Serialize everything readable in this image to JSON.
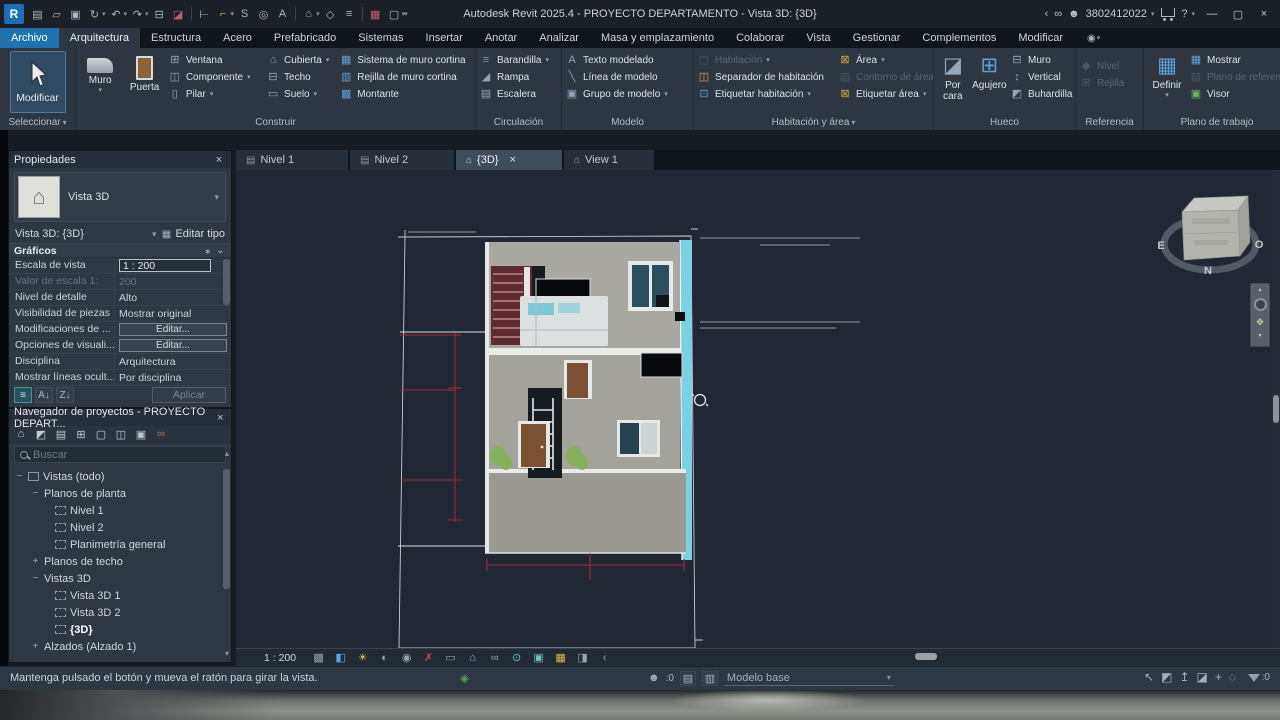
{
  "colors": {
    "accent_blue": "#1e73ae",
    "ribbon_bg": "#2e3741",
    "canvas_bg": "#212834",
    "model_teal_wall": "#7bd0e2",
    "dimension_red": "#9c2e36",
    "icon_blue": "#5f9fd6",
    "icon_yellow": "#d8a83c"
  },
  "icons": {
    "revit": "R",
    "doc": "▤",
    "folder": "▱",
    "save": "▣",
    "sync": "↻",
    "undo": "↶",
    "redo": "↷",
    "print": "⊟",
    "transfer": "◪",
    "measure": "⊢",
    "dimension": "⌐",
    "spline": "S",
    "tag": "◎",
    "text": "A",
    "home": "⌂",
    "marker": "◇",
    "thinlines": "≡",
    "closewin": "▦",
    "cascade": "▢",
    "chev_left": "‹",
    "binoculars": "∞",
    "user": "☻",
    "help": "?",
    "minimize": "—",
    "restore": "▢",
    "close": "×",
    "camera": "◉",
    "window": "⊞",
    "component": "◫",
    "pillar": "▯",
    "roof": "⌂",
    "ceiling": "⊟",
    "floor": "▭",
    "curtain_system": "▦",
    "curtain_grid": "▥",
    "mullion": "▩",
    "railing": "≡",
    "ramp": "◢",
    "stair": "▤",
    "model_text": "A",
    "model_line": "╲",
    "model_group": "▣",
    "room": "▢",
    "room_separator": "◫",
    "tag_room": "⊡",
    "area": "⊠",
    "area_boundary": "▧",
    "tag_area": "⊠",
    "by_face": "◪",
    "shaft": "⊞",
    "wall_opening": "⊟",
    "vertical_opening": "↕",
    "dormer": "◩",
    "level": "◆",
    "grid": "⊞",
    "show": "▦",
    "ref_plane": "▨",
    "viewer": "▣",
    "edit_type_grid": "▦",
    "sort_menu": "≡",
    "sort_az": "A↓",
    "sort_za": "Z↓",
    "tree_home": "⌂",
    "tree_views": "◩",
    "tree_sheets": "▤",
    "tree_schedules": "⊞",
    "tree_legends": "▢",
    "tree_families": "◫",
    "tree_groups": "▣",
    "tree_links": "∞",
    "worksharing": "◈",
    "person": "☻",
    "list1": "▤",
    "list2": "▥",
    "sel_links": "↖",
    "sel_underlay": "◩",
    "sel_pinned": "↥",
    "sel_face": "◪",
    "sel_drag": "+",
    "sel_circle": "◌",
    "plan_tab": "▤",
    "house_tab": "⌂",
    "up": "▴",
    "down": "▾"
  },
  "titlebar": {
    "title": "Autodesk Revit 2025.4 - PROYECTO DEPARTAMENTO - Vista 3D: {3D}",
    "account_id": "3802412022"
  },
  "tabs": [
    "Archivo",
    "Arquitectura",
    "Estructura",
    "Acero",
    "Prefabricado",
    "Sistemas",
    "Insertar",
    "Anotar",
    "Analizar",
    "Masa y emplazamiento",
    "Colaborar",
    "Vista",
    "Gestionar",
    "Complementos",
    "Modificar"
  ],
  "ribbon": {
    "seleccionar": {
      "label": "Seleccionar",
      "modificar": "Modificar"
    },
    "construir": {
      "label": "Construir",
      "muro": "Muro",
      "puerta": "Puerta",
      "ventana": "Ventana",
      "componente": "Componente",
      "pilar": "Pilar",
      "cubierta": "Cubierta",
      "techo": "Techo",
      "suelo": "Suelo",
      "sistema": "Sistema de muro cortina",
      "rejilla": "Rejilla de muro cortina",
      "montante": "Montante"
    },
    "circulacion": {
      "label": "Circulación",
      "barandilla": "Barandilla",
      "rampa": "Rampa",
      "escalera": "Escalera"
    },
    "modelo": {
      "label": "Modelo",
      "texto": "Texto modelado",
      "linea": "Línea de modelo",
      "grupo": "Grupo de modelo"
    },
    "habitacion": {
      "label": "Habitación y área",
      "habitacion": "Habitación",
      "separador": "Separador  de habitación",
      "etiquetar_hab": "Etiquetar  habitación",
      "area": "Área",
      "contorno": "Contorno  de área",
      "etiquetar_area": "Etiquetar  área"
    },
    "hueco": {
      "label": "Hueco",
      "por_cara": "Por cara",
      "agujero": "Agujero",
      "muro": "Muro",
      "vertical": "Vertical",
      "buhardilla": "Buhardilla"
    },
    "referencia": {
      "label": "Referencia",
      "nivel": "Nivel",
      "rejilla": "Rejilla"
    },
    "plano": {
      "label": "Plano de trabajo",
      "definir": "Definir",
      "mostrar": "Mostrar",
      "plano_ref": "Plano de referencia",
      "visor": "Visor"
    }
  },
  "properties": {
    "title": "Propiedades",
    "type_name": "Vista 3D",
    "instance": "Vista 3D: {3D}",
    "edit_type": "Editar tipo",
    "section": "Gráficos",
    "rows": [
      {
        "label": "Escala de vista",
        "value": "1 : 200"
      },
      {
        "label": "Valor de escala  1:",
        "value": "200"
      },
      {
        "label": "Nivel de detalle",
        "value": "Alto"
      },
      {
        "label": "Visibilidad de piezas",
        "value": "Mostrar original"
      },
      {
        "label": "Modificaciones de ...",
        "value": "Editar..."
      },
      {
        "label": "Opciones de visuali...",
        "value": "Editar..."
      },
      {
        "label": "Disciplina",
        "value": "Arquitectura"
      },
      {
        "label": "Mostrar líneas ocult...",
        "value": "Por disciplina"
      }
    ],
    "apply": "Aplicar"
  },
  "browser": {
    "title": "Navegador de proyectos - PROYECTO DEPART...",
    "search_placeholder": "Buscar",
    "tree": [
      {
        "label": "Vistas (todo)",
        "exp": "−"
      },
      {
        "label": "Planos de planta",
        "exp": "−"
      },
      {
        "label": "Nivel 1"
      },
      {
        "label": "Nivel 2"
      },
      {
        "label": "Planimetría general"
      },
      {
        "label": "Planos de techo",
        "exp": "+"
      },
      {
        "label": "Vistas 3D",
        "exp": "−"
      },
      {
        "label": "Vista 3D 1"
      },
      {
        "label": "Vista 3D 2"
      },
      {
        "label": "{3D}"
      },
      {
        "label": "Alzados (Alzado 1)",
        "exp": "+"
      }
    ]
  },
  "view_tabs": [
    "Nivel 1",
    "Nivel 2",
    "{3D}",
    "View 1"
  ],
  "canvas": {
    "compass": {
      "e": "E",
      "o": "O",
      "n": "N"
    }
  },
  "view_control": {
    "scale": "1 : 200",
    "icons": [
      {
        "name": "detail-level",
        "glyph": "▩"
      },
      {
        "name": "visual-style",
        "glyph": "◧"
      },
      {
        "name": "sun-path",
        "glyph": "☀"
      },
      {
        "name": "shadows",
        "glyph": "◐"
      },
      {
        "name": "rendering",
        "glyph": "◉"
      },
      {
        "name": "crop-view",
        "glyph": "✗"
      },
      {
        "name": "crop-region",
        "glyph": "▭"
      },
      {
        "name": "lock-3d-view",
        "glyph": "⌂"
      },
      {
        "name": "reveal-hidden",
        "glyph": "∞"
      },
      {
        "name": "temporary-isolate",
        "glyph": "⊙"
      },
      {
        "name": "displace-elements",
        "glyph": "▣"
      },
      {
        "name": "reveal-constraints",
        "glyph": "▦"
      },
      {
        "name": "section-box",
        "glyph": "◨"
      },
      {
        "name": "more",
        "glyph": "‹"
      }
    ]
  },
  "statusbar": {
    "message": "Mantenga pulsado el botón y mueva el ratón para girar la vista.",
    "editable_count": ":0",
    "design_option": "Modelo base",
    "filter_count": ":0"
  }
}
